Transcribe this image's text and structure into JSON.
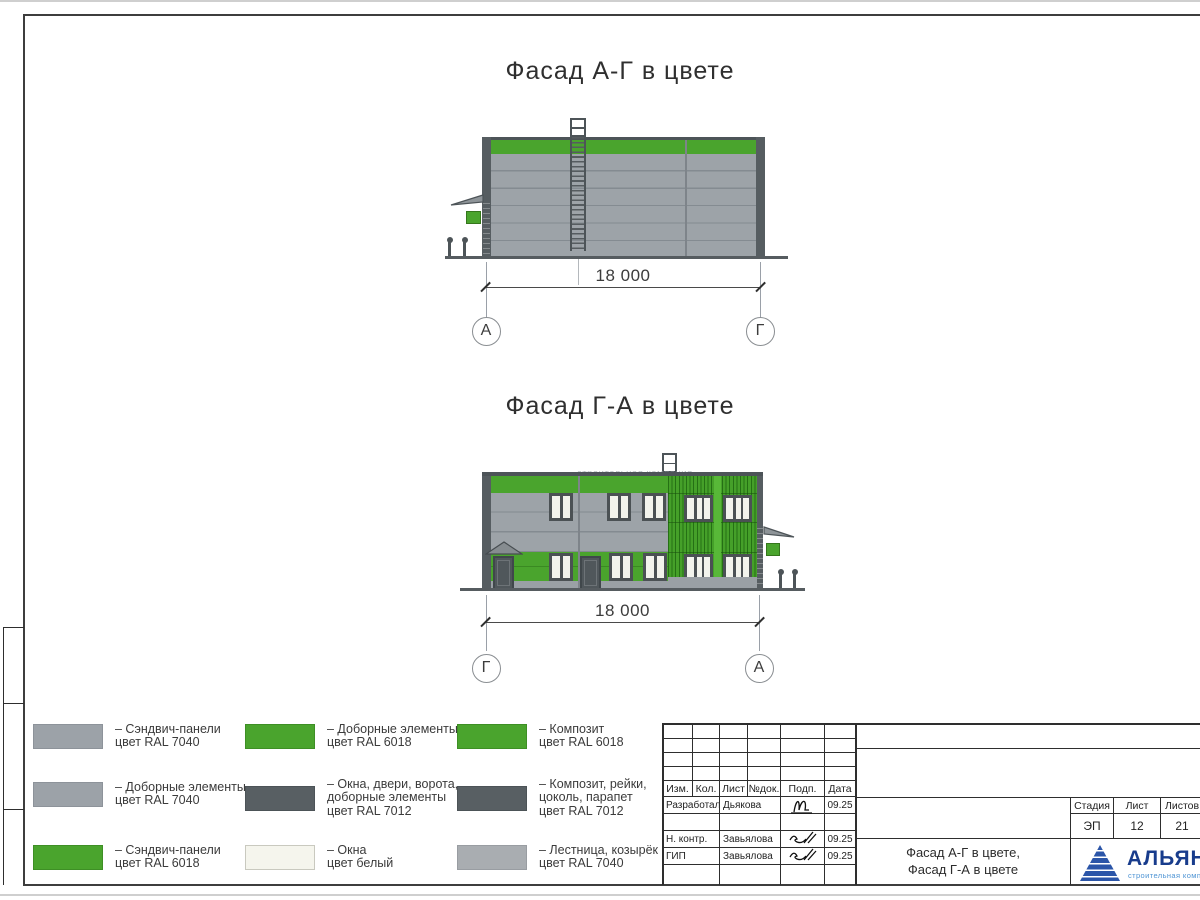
{
  "page": {
    "facade1": {
      "title": "Фасад А-Г в цвете",
      "dimension": "18 000",
      "axis_left": "А",
      "axis_right": "Г"
    },
    "facade2": {
      "title": "Фасад Г-А в цвете",
      "dimension": "18 000",
      "axis_left": "Г",
      "axis_right": "А",
      "watermark": "строительная компания"
    },
    "colors": {
      "ral6018_green": "#4AA42D",
      "ral7040_panels": "#9DA3A8",
      "ral7040_light": "#A9ADB1",
      "ral7012_dark": "#585F63",
      "window_white": "#F5F5ED",
      "frame_dark": "#4D5458",
      "logo_blue": "#183C8C"
    },
    "legend": {
      "items": [
        {
          "color": "#9CA2A8",
          "lines": [
            "– Сэндвич-панели",
            "цвет RAL 7040"
          ]
        },
        {
          "color": "#9CA2A8",
          "lines": [
            "– Доборные элементы",
            "цвет RAL 7040"
          ]
        },
        {
          "color": "#4AA42D",
          "lines": [
            "– Сэндвич-панели",
            "цвет RAL 6018"
          ]
        },
        {
          "color": "#4AA42D",
          "lines": [
            "– Доборные элементы",
            "цвет RAL 6018"
          ]
        },
        {
          "color": "#585F63",
          "lines": [
            "– Окна, двери, ворота,",
            "доборные элементы",
            "цвет RAL 7012"
          ]
        },
        {
          "color": "#F5F5ED",
          "lines": [
            "– Окна",
            "цвет белый"
          ]
        },
        {
          "color": "#4AA42D",
          "lines": [
            "– Композит",
            "цвет RAL 6018"
          ]
        },
        {
          "color": "#585F63",
          "lines": [
            "– Композит, рейки,",
            "цоколь, парапет",
            "цвет RAL 7012"
          ]
        },
        {
          "color": "#A9ADB1",
          "lines": [
            "– Лестница, козырёк",
            "цвет RAL 7040"
          ]
        }
      ]
    },
    "titleblock": {
      "rev_header": {
        "izm": "Изм.",
        "kol": "Кол.",
        "list": "Лист",
        "ndok": "№док.",
        "podp": "Подп.",
        "data": "Дата"
      },
      "rows": [
        {
          "role": "Разработал",
          "name": "Дьякова",
          "date": "09.25"
        },
        {
          "role": "Н. контр.",
          "name": "Завьялова",
          "date": "09.25"
        },
        {
          "role": "ГИП",
          "name": "Завьялова",
          "date": "09.25"
        }
      ],
      "doc_title1": "Фасад А-Г в цвете,",
      "doc_title2": "Фасад Г-А в цвете",
      "stage_header": {
        "stadia": "Стадия",
        "list": "Лист",
        "listov": "Листов"
      },
      "stage_values": {
        "stadia": "ЭП",
        "list": "12",
        "listov": "21"
      }
    },
    "logo": {
      "name": "АЛЬЯНС",
      "tagline": "строительная компания"
    }
  }
}
